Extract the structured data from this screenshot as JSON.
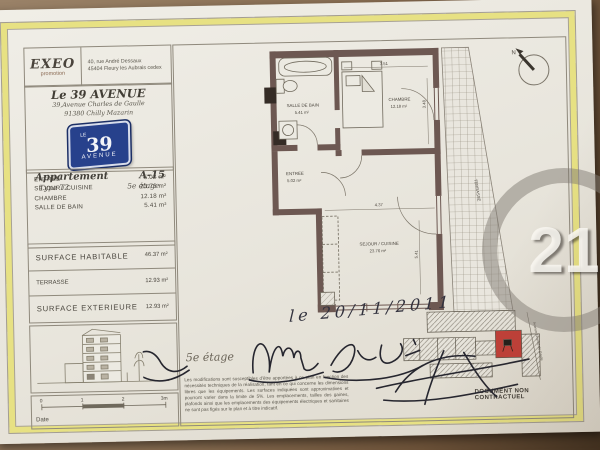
{
  "brand": {
    "name": "EXEO",
    "sub": "promotion",
    "address1": "40, rue André Dessaux",
    "address2": "45404 Fleury les Aubrais cedex"
  },
  "project": {
    "title": "Le 39 AVENUE",
    "address1": "39,Avenue Charles de Gaulle",
    "address2": "91380 Chilly Mazarin",
    "sign": {
      "top": "LE",
      "number": "39",
      "bottom": "AVENUE"
    },
    "apartment_label": "Appartement",
    "apartment_number": "A-15",
    "type": "Type T2",
    "floor": "5e étage"
  },
  "rooms": [
    {
      "label": "ENTREE",
      "area": "5.02 m²"
    },
    {
      "label": "SEJOUR / CUISINE",
      "area": "23.76 m²"
    },
    {
      "label": "CHAMBRE",
      "area": "12.18 m²"
    },
    {
      "label": "SALLE DE BAIN",
      "area": "5.41 m²"
    }
  ],
  "surfaces": [
    {
      "label": "SURFACE HABITABLE",
      "area": "46.37 m²"
    },
    {
      "label": "TERRASSE",
      "area": "12.93 m²"
    },
    {
      "label": "SURFACE EXTERIEURE",
      "area": "12.93 m²"
    }
  ],
  "plan": {
    "labels": {
      "salle_de_bain": {
        "name": "SALLE DE BAIN",
        "area": "5.41 m²"
      },
      "chambre": {
        "name": "CHAMBRE",
        "area": "12.18 m²"
      },
      "entree": {
        "name": "ENTREE",
        "area": "5.02 m²"
      },
      "sejour": {
        "name": "SEJOUR / CUISINE",
        "area": "23.76 m²"
      },
      "terrasse": {
        "name": "TERRASSE",
        "area": "12.93 m²"
      }
    },
    "dimensions": {
      "chambre_width": "3.51",
      "chambre_height": "3.48",
      "sejour_width": "4.37",
      "sejour_height": "5.41"
    },
    "north": "N"
  },
  "site_plan": {
    "street": "Avenue Charles de Gaulle"
  },
  "footer": {
    "floor_note": "5e étage",
    "handwritten_date": "le 20/11/2011",
    "disclaimer": "Les modifications sont susceptibles d'être apportées à ce plan en fonction des nécessités techniques de la réalisation, tant en ce qui concerne les dimensions libres que les équipements. Les surfaces indiquées sont approximatives et pourront varier dans la limite de 5%. Les emplacements, tailles des gaines, plafonds ainsi que les emplacements des équipements électriques et sanitaires ne sont pas figés sur le plan et à titre indicatif.",
    "non_contractual": "DOCUMENT NON CONTRACTUEL",
    "date_label": "Date",
    "scale_ticks": [
      "0",
      "1",
      "2",
      "3m"
    ],
    "watermark_number": "21"
  },
  "colors": {
    "wall": "#6d5852",
    "unit_highlight": "#c04038",
    "sign_blue": "#27418c",
    "frame_yellow": "#e7e183"
  }
}
